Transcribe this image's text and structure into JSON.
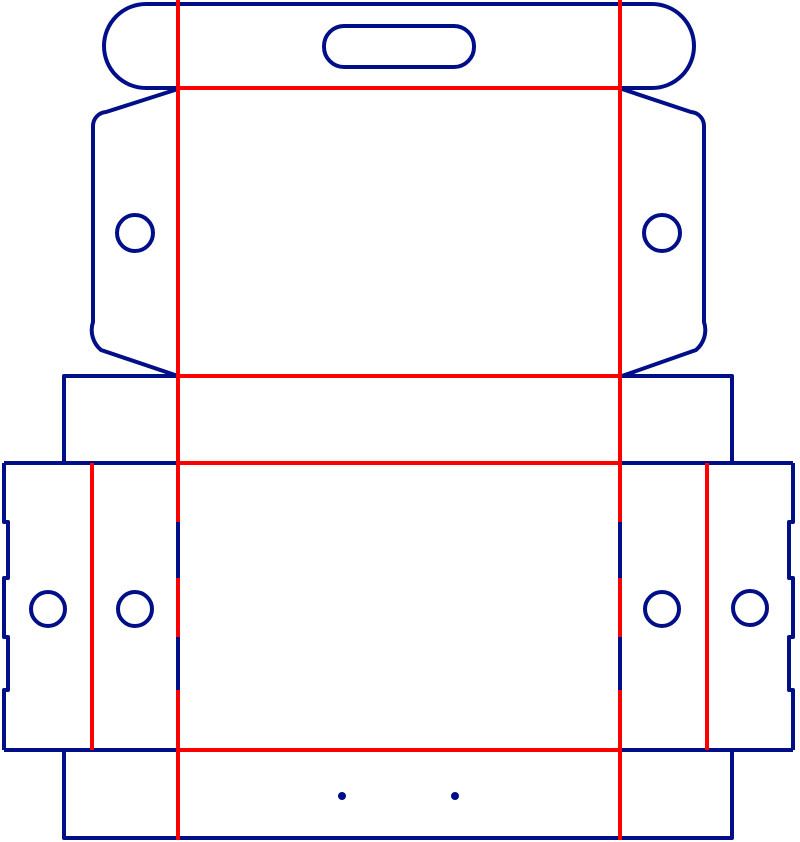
{
  "diagram": {
    "type": "packaging-dieline",
    "description": "Die-cut box template with cut lines and crease lines",
    "canvas": {
      "width": 800,
      "height": 842,
      "background": "#ffffff"
    },
    "line_styles": {
      "cut": {
        "color": "#000f87",
        "meaning": "cut line (blue)"
      },
      "crease": {
        "color": "#fc0000",
        "meaning": "fold / crease line (red)"
      }
    },
    "stroke_width": 4,
    "shapes": [
      {
        "name": "lid-flap-outline",
        "kind": "path",
        "line": "cut",
        "d": "M 622 88 L 652 88 A 42 42 0 0 0 652 4 L 146 4 A 42 42 0 0 0 146 88 L 178 88"
      },
      {
        "name": "handle-slot",
        "kind": "rect",
        "line": "cut",
        "x": 324,
        "y": 26,
        "w": 150,
        "h": 41,
        "rx": 20
      },
      {
        "name": "left-wing-outline",
        "kind": "path",
        "line": "cut",
        "d": "M 178 89 L 106 112 A 14 14 0 0 0 93 126 L 93 322 A 26 26 0 0 0 101 350 L 178 376"
      },
      {
        "name": "right-wing-outline",
        "kind": "path",
        "line": "cut",
        "d": "M 622 89 L 691 112 A 14 14 0 0 1 704 126 L 704 322 A 26 26 0 0 1 696 350 L 622 376"
      },
      {
        "name": "left-wing-hole",
        "kind": "circle",
        "line": "cut",
        "cx": 135,
        "cy": 233,
        "r": 18
      },
      {
        "name": "right-wing-hole",
        "kind": "circle",
        "line": "cut",
        "cx": 662,
        "cy": 233,
        "r": 18
      },
      {
        "name": "upper-band-left-edge",
        "kind": "path",
        "line": "cut",
        "d": "M 178 376 L 64 376 L 64 461"
      },
      {
        "name": "upper-band-right-edge",
        "kind": "path",
        "line": "cut",
        "d": "M 622 376 L 732 376 L 732 461"
      },
      {
        "name": "main-top-edge-left",
        "kind": "path",
        "line": "cut",
        "d": "M 4 463 L 178 463"
      },
      {
        "name": "main-top-edge-right",
        "kind": "path",
        "line": "cut",
        "d": "M 620 463 L 793 463"
      },
      {
        "name": "main-left-edge-notched",
        "kind": "path",
        "line": "cut",
        "d": "M 4 463 L 4 522 L 8 522 L 8 578 L 4 578 L 4 637 L 8 637 L 8 690 L 4 690 L 4 750"
      },
      {
        "name": "main-right-edge-notched",
        "kind": "path",
        "line": "cut",
        "d": "M 793 463 L 793 522 L 789 522 L 789 578 L 793 578 L 793 637 L 789 637 L 789 690 L 793 690 L 793 750"
      },
      {
        "name": "main-bottom-edge-left",
        "kind": "path",
        "line": "cut",
        "d": "M 4 750 L 178 750"
      },
      {
        "name": "main-bottom-edge-right",
        "kind": "path",
        "line": "cut",
        "d": "M 620 750 L 793 750"
      },
      {
        "name": "left-slit-upper",
        "kind": "path",
        "line": "cut",
        "d": "M 178 522 L 178 578"
      },
      {
        "name": "left-slit-lower",
        "kind": "path",
        "line": "cut",
        "d": "M 178 637 L 178 690"
      },
      {
        "name": "right-slit-upper",
        "kind": "path",
        "line": "cut",
        "d": "M 620 522 L 620 578"
      },
      {
        "name": "right-slit-lower",
        "kind": "path",
        "line": "cut",
        "d": "M 620 637 L 620 690"
      },
      {
        "name": "glue-flap-left-hole",
        "kind": "circle",
        "line": "cut",
        "cx": 48,
        "cy": 609,
        "r": 17
      },
      {
        "name": "side-panel-left-hole",
        "kind": "circle",
        "line": "cut",
        "cx": 135,
        "cy": 609,
        "r": 17
      },
      {
        "name": "side-panel-right-hole",
        "kind": "circle",
        "line": "cut",
        "cx": 662,
        "cy": 609,
        "r": 17
      },
      {
        "name": "glue-flap-right-hole",
        "kind": "circle",
        "line": "cut",
        "cx": 750,
        "cy": 608,
        "r": 17
      },
      {
        "name": "lower-band-outline",
        "kind": "path",
        "line": "cut",
        "d": "M 64 750 L 64 838 L 732 838 L 732 750"
      },
      {
        "name": "registration-dot-left",
        "kind": "circle",
        "fill": "cut",
        "cx": 342,
        "cy": 796,
        "r": 4
      },
      {
        "name": "registration-dot-right",
        "kind": "circle",
        "fill": "cut",
        "cx": 455,
        "cy": 796,
        "r": 4
      },
      {
        "name": "crease-lid-fold",
        "kind": "path",
        "line": "crease",
        "d": "M 178 88 L 620 88"
      },
      {
        "name": "crease-upper-band-top",
        "kind": "path",
        "line": "crease",
        "d": "M 178 376 L 620 376"
      },
      {
        "name": "crease-main-top",
        "kind": "path",
        "line": "crease",
        "d": "M 178 463 L 620 463"
      },
      {
        "name": "crease-main-bottom",
        "kind": "path",
        "line": "crease",
        "d": "M 178 750 L 620 750"
      },
      {
        "name": "crease-left-vertical-a",
        "kind": "path",
        "line": "crease",
        "d": "M 178 0 L 178 522"
      },
      {
        "name": "crease-left-vertical-b",
        "kind": "path",
        "line": "crease",
        "d": "M 178 578 L 178 637"
      },
      {
        "name": "crease-left-vertical-c",
        "kind": "path",
        "line": "crease",
        "d": "M 178 690 L 178 840"
      },
      {
        "name": "crease-right-vertical-a",
        "kind": "path",
        "line": "crease",
        "d": "M 620 0 L 620 522"
      },
      {
        "name": "crease-right-vertical-b",
        "kind": "path",
        "line": "crease",
        "d": "M 620 578 L 620 637"
      },
      {
        "name": "crease-right-vertical-c",
        "kind": "path",
        "line": "crease",
        "d": "M 620 690 L 620 840"
      },
      {
        "name": "crease-glue-flap-left",
        "kind": "path",
        "line": "crease",
        "d": "M 92 463 L 92 750"
      },
      {
        "name": "crease-glue-flap-right",
        "kind": "path",
        "line": "crease",
        "d": "M 707 463 L 707 750"
      }
    ]
  }
}
